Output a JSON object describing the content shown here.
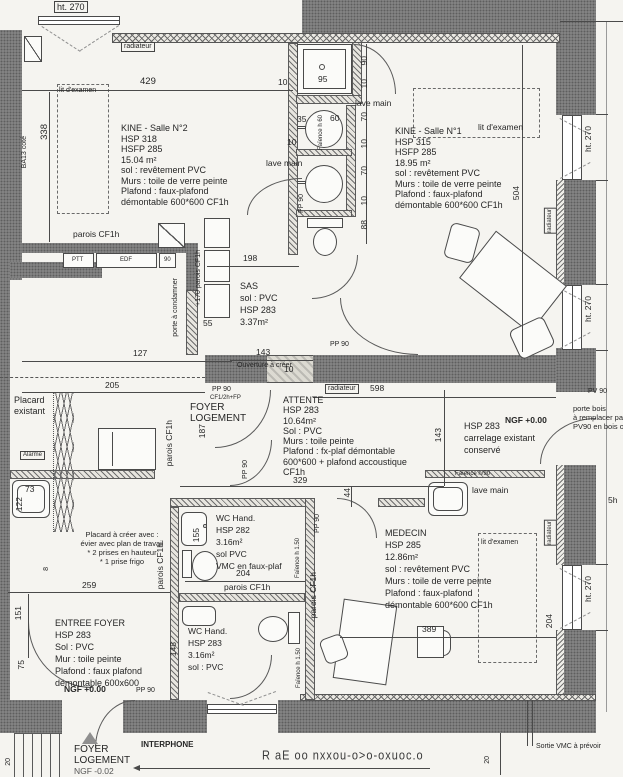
{
  "rooms": {
    "kine2": {
      "lines": [
        "KINE - Salle N°2",
        "HSP 318",
        "HSFP 285",
        "15.04 m²",
        "sol : revêtement PVC",
        "Murs : toile de verre peinte",
        "Plafond : faux-plafond",
        "démontable 600*600 CF1h"
      ]
    },
    "kine1": {
      "lines": [
        "KINE - Salle N°1",
        "HSP 315",
        "HSFP 285",
        "18.95 m²",
        "sol : revêtement PVC",
        "Murs : toile de verre peinte",
        "Plafond : faux-plafond",
        "démontable 600*600 CF1h"
      ]
    },
    "sas": {
      "lines": [
        "SAS",
        "sol : PVC",
        "HSP 283",
        "3.37m²"
      ]
    },
    "attente": {
      "lines": [
        "ATTENTE",
        "HSP 283",
        "10.64m²",
        "Sol : PVC",
        "Murs : toile peinte",
        "Plafond : fx-plaf démontable",
        "600*600 + plafond accoustique",
        "CF1h"
      ]
    },
    "wc1": {
      "lines": [
        "WC Hand.",
        "HSP 282",
        "3.16m²",
        "sol PVC",
        "VMC en faux-plaf"
      ]
    },
    "wc2": {
      "lines": [
        "WC Hand.",
        "HSP 283",
        "3.16m²",
        "sol : PVC"
      ]
    },
    "medecin": {
      "lines": [
        "MEDECIN",
        "HSP 285",
        "12.86m²",
        "sol : revêtement PVC",
        "Murs : toile de verre peinte",
        "Plafond : faux-plafond",
        "démontable 600*600 CF1h"
      ]
    },
    "entree": {
      "lines": [
        "ENTREE FOYER",
        "HSP 283",
        "Sol : PVC",
        "Mur : toile peinte",
        "Plafond : faux plafond",
        "démontable 600x600"
      ]
    },
    "carrelage": {
      "lines": [
        "HSP 283",
        "carrelage existant",
        "conservé"
      ]
    },
    "placard_creer": {
      "lines": [
        "Placard à créer avec :",
        "évier avec plan de travail",
        "* 2 prises en hauteur",
        "* 1 prise frigo"
      ]
    },
    "porte_bois": {
      "lines": [
        "porte bois",
        "à remplacer par",
        "PV90 en bois ou"
      ]
    },
    "placard_ex": {
      "lines": [
        "Placard",
        "existant"
      ]
    },
    "foyer_a": {
      "lines": [
        "FOYER",
        "LOGEMENT"
      ]
    },
    "foyer_b": {
      "lines": [
        "FOYER",
        "LOGEMENT",
        "NGF -0.02"
      ]
    }
  },
  "labels": {
    "ht270": "ht. 270",
    "lit": "lit d'examen",
    "lave": "lave main",
    "rad": "radiateur",
    "parois": "parois CF1h",
    "pcond": "porte à condamner",
    "p170": "+170 parois CF1h",
    "ouv": "Ouverture à créer",
    "ngf0": "NGF +0.00",
    "ngf2": "NGF -0.02",
    "inter": "INTERPHONE",
    "alarme": "Alarme",
    "vmc": "Sortie VMC à prévoir",
    "pp90": "PP 90",
    "pv90": "PV 90",
    "cf12": "CF1/2h+FP",
    "ba13": "BA13 coté",
    "f60": "Faïence h 60",
    "f90": "Faïence h/90",
    "f150": "Faïence h 1.50",
    "h5": "5h",
    "rot": "R aE oo nxxou-o>o-oxuoc.o"
  },
  "dims": {
    "d429": "429",
    "d338": "338",
    "d10top": "10",
    "d95": "95",
    "d90": "90",
    "d10a": "10",
    "d70a": "70",
    "d10b": "10",
    "d70b": "70",
    "d10c": "10",
    "d88": "88",
    "d35": "35",
    "d60": "60",
    "d10lm": "10",
    "d504": "504",
    "d198": "198",
    "d55": "55",
    "d127": "127",
    "d10brk": "10",
    "d143o": "143",
    "d205": "205",
    "d598": "598",
    "d329": "329",
    "d44": "44",
    "d143v": "143",
    "d187": "187",
    "d73": "73",
    "d122": "122",
    "d8": "8",
    "d259": "259",
    "d151": "151",
    "d75": "75",
    "d155": "155",
    "d204wc": "204",
    "d148": "148",
    "d389": "389",
    "d204med": "204",
    "d20a": "20",
    "d20b": "20"
  },
  "small": {
    "ptt": "PTT",
    "edf": "EDF",
    "n90": "90"
  },
  "colors": {
    "wall": "#8a8a8a",
    "paper": "#f5f4f0",
    "line": "#4a4a4a"
  }
}
